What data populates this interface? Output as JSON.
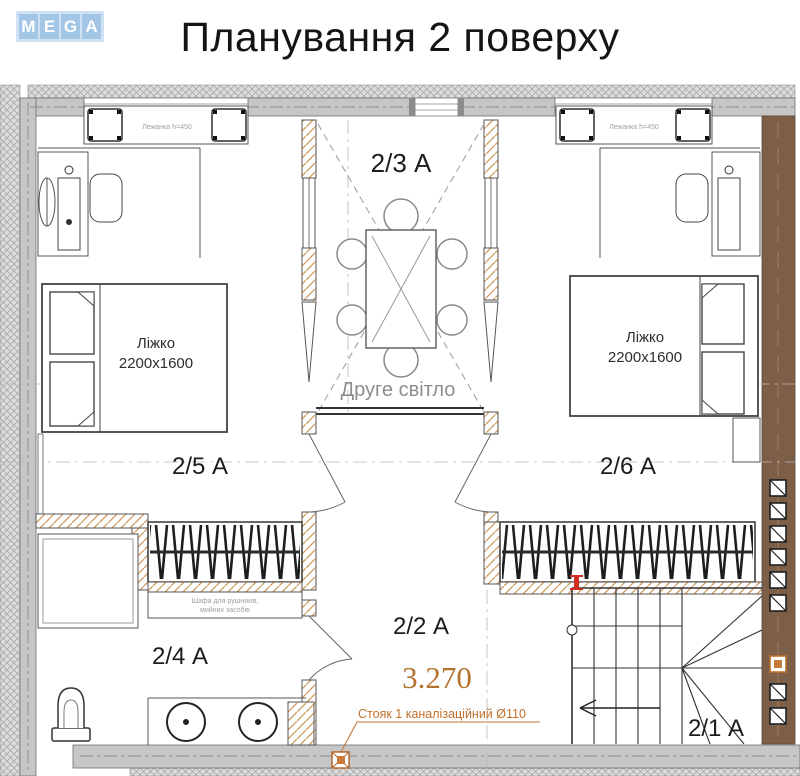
{
  "header": {
    "logo_letters": [
      "M",
      "E",
      "G",
      "A"
    ],
    "title": "Планування 2 поверху"
  },
  "plan": {
    "rooms": {
      "hall": "2/3 А",
      "bedroom_left": "2/5 А",
      "bedroom_right": "2/6 А",
      "bathroom": "2/4 А",
      "corridor": "2/2 А",
      "stairs": "2/1 А"
    },
    "annotations": {
      "second_light": "Друге світло",
      "level_mark": "3.270",
      "riser_note": "Стояк 1 каналізаційний Ø110",
      "bench_label": "Лежанка h=450",
      "cabinet_line1": "Шафа для рушників,",
      "cabinet_line2": "мийних засобів"
    },
    "furniture": {
      "bed_label": "Ліжко",
      "bed_size": "2200x1600"
    },
    "colors": {
      "logo_blue": "#a3c6e7",
      "wall_gray": "#c6c6c6",
      "wood_brown": "#7d5f48",
      "accent_orange": "#c0702c",
      "hatch_tan": "#cf9a5c",
      "marker_red": "#cf2e20"
    }
  }
}
